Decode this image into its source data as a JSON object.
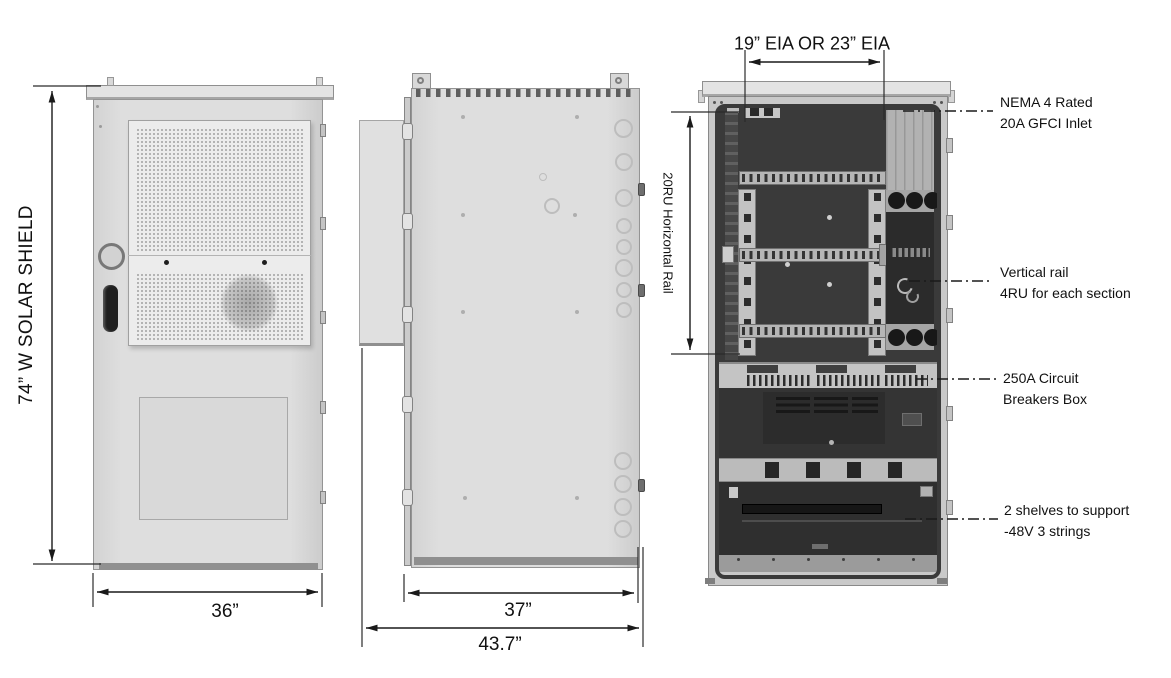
{
  "drawing": {
    "title": "Outdoor cabinet three-view drawing",
    "views": [
      "front-view",
      "side-view",
      "interior-view"
    ]
  },
  "dimensions": {
    "front_height": "74” W SOLAR SHIELD",
    "front_width": "36”",
    "side_depth": "37”",
    "side_total_depth": "43.7”",
    "rack_width": "19” EIA OR 23” EIA",
    "rack_rail": "20RU Horizontal Rail"
  },
  "annotations": [
    {
      "id": "gfci-inlet",
      "line1": "NEMA 4 Rated",
      "line2": "20A GFCI Inlet"
    },
    {
      "id": "vertical-rail",
      "line1": "Vertical rail",
      "line2": "4RU for each section"
    },
    {
      "id": "breaker-box",
      "line1": "250A Circuit",
      "line2": "Breakers Box"
    },
    {
      "id": "battery-shelves",
      "line1": "2 shelves to support",
      "line2": "-48V 3 strings"
    }
  ],
  "colors": {
    "background": "#ffffff",
    "cabinet_body": "#dcdcdc",
    "cabinet_interior": "#3a3a3a",
    "rail_metal": "#c2c2c2",
    "line": "#1a1a1a"
  }
}
